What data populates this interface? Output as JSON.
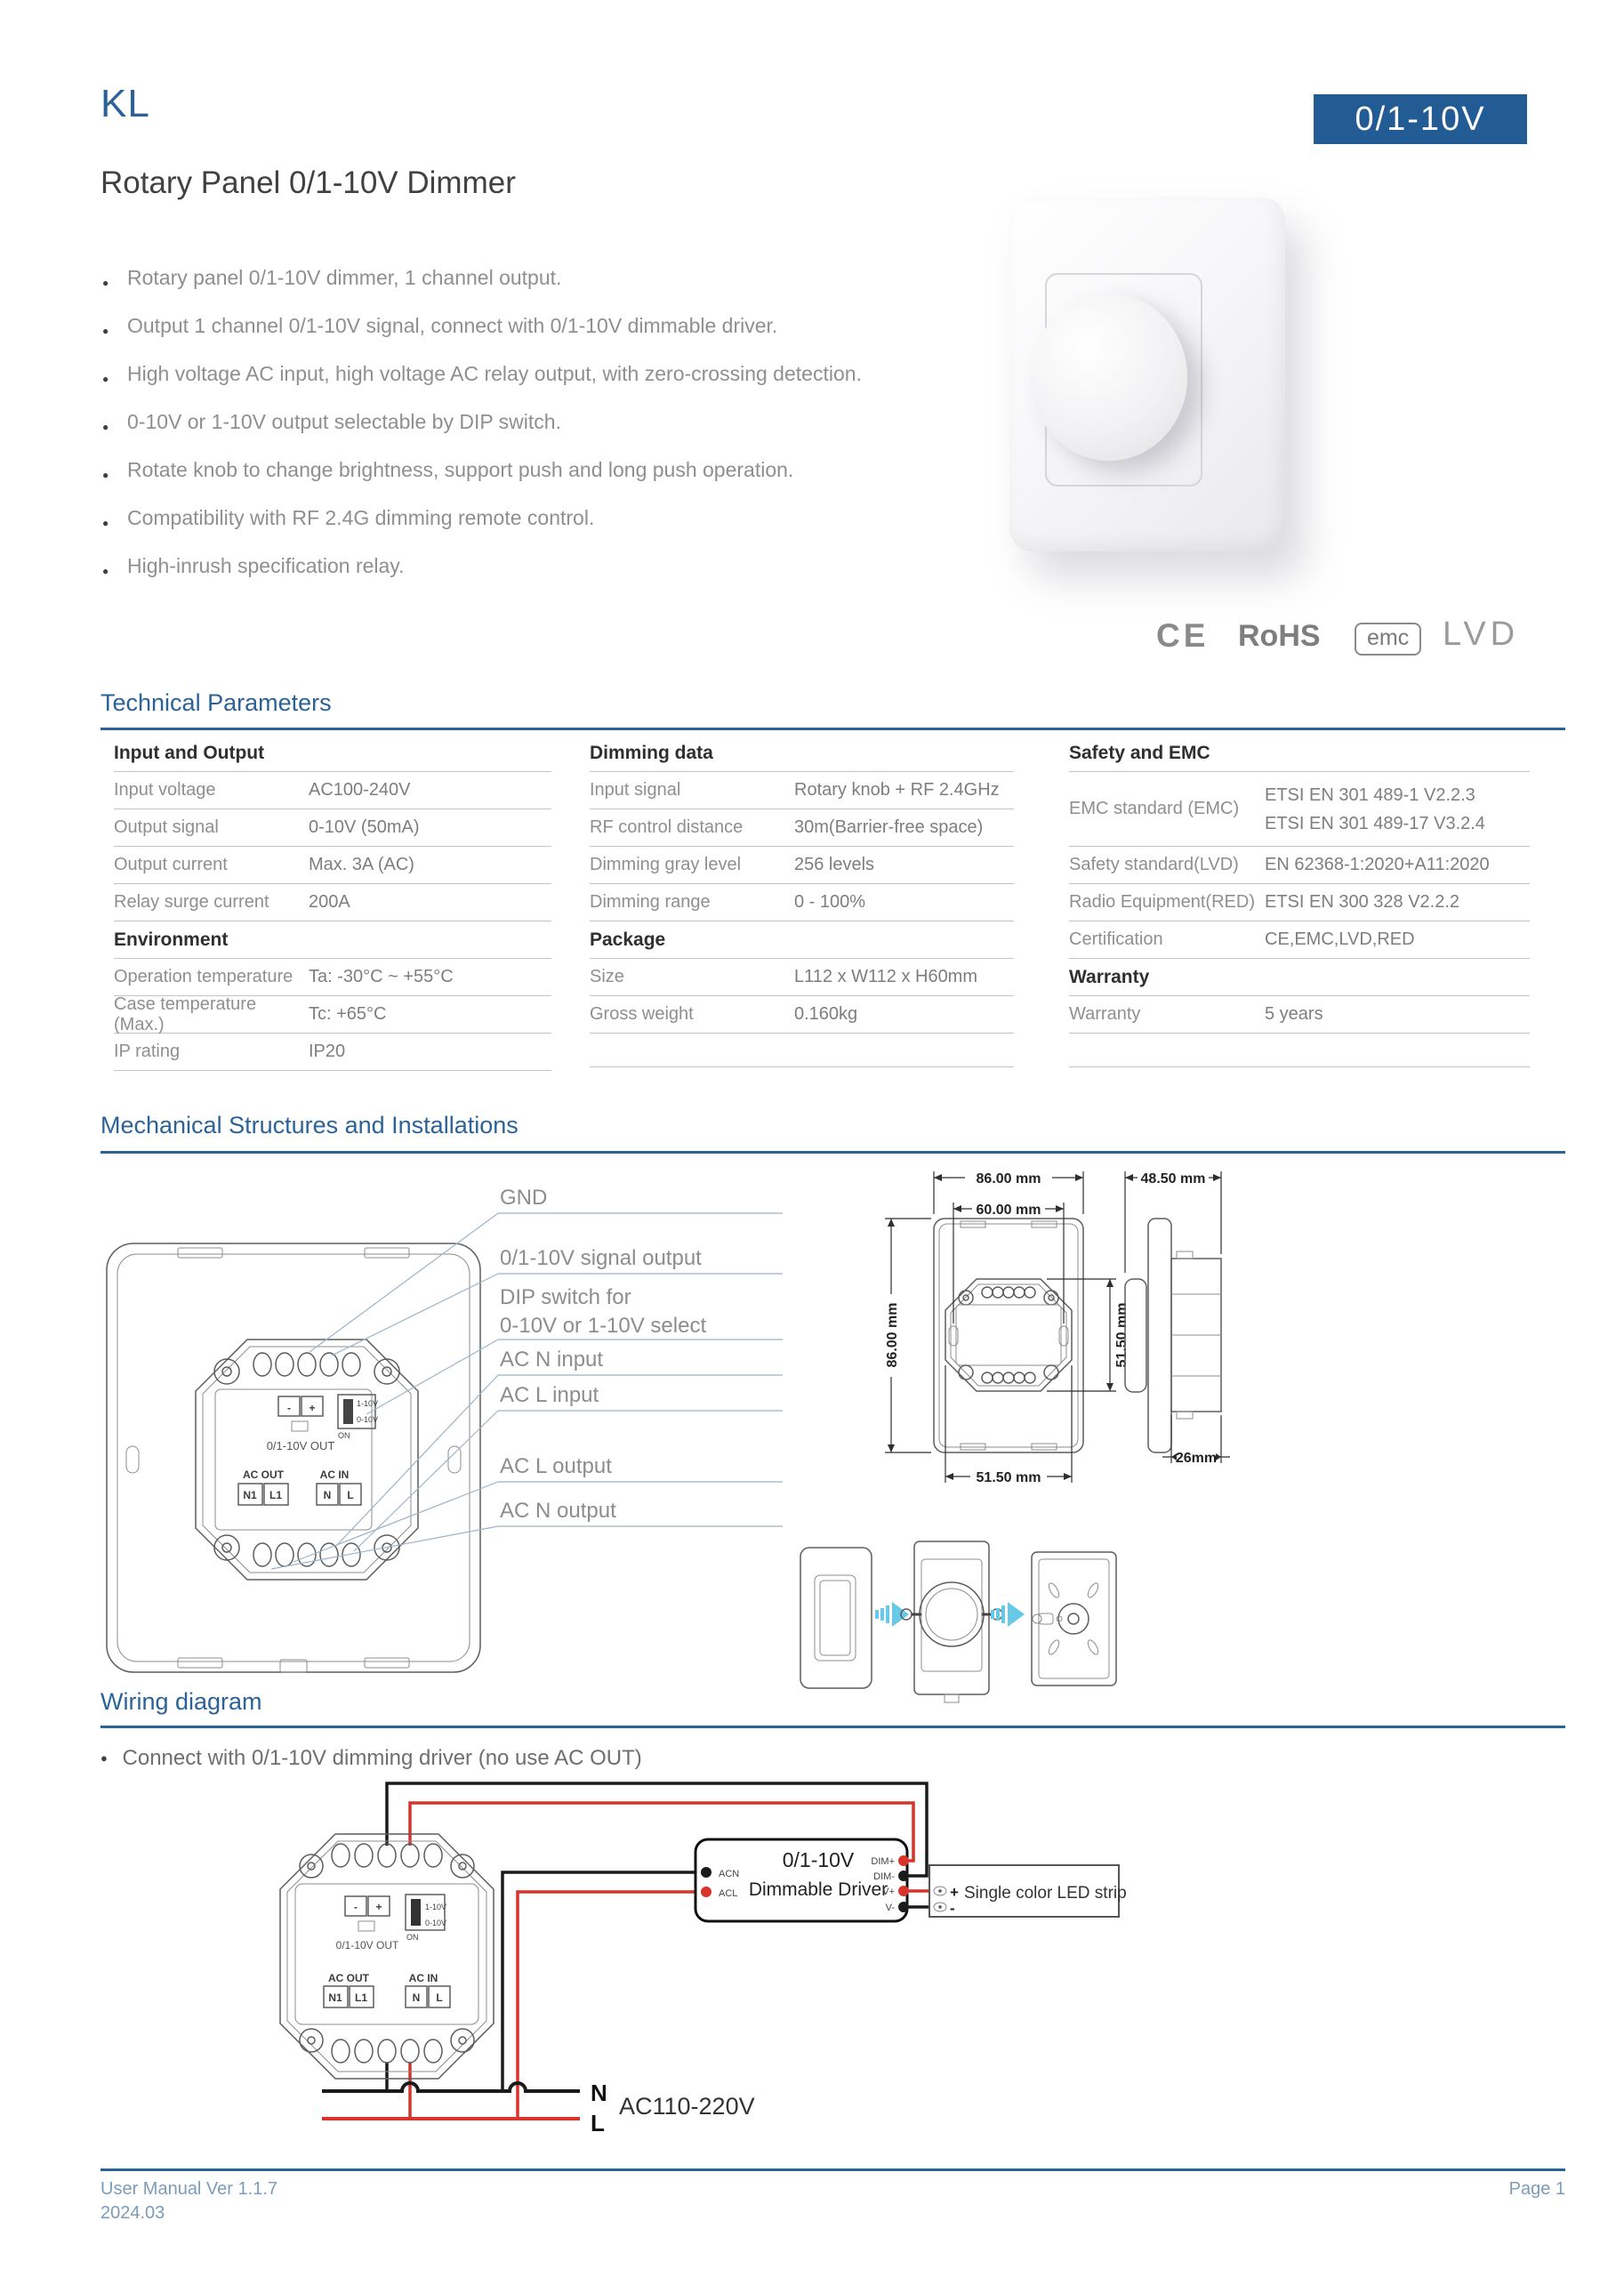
{
  "colors": {
    "accent_blue": "#2b6398",
    "badge_bg": "#235c95",
    "wire_red": "#d8342c",
    "wire_black": "#1b1b1b",
    "arrow_cyan": "#66c9e8"
  },
  "header": {
    "product_code": "KL",
    "title": "Rotary Panel 0/1-10V Dimmer",
    "badge": "0/1-10V"
  },
  "features": [
    "Rotary panel 0/1-10V dimmer, 1 channel output.",
    "Output 1 channel 0/1-10V signal, connect with 0/1-10V dimmable driver.",
    "High voltage AC input, high voltage AC relay output, with zero-crossing detection.",
    "0-10V or 1-10V output selectable by DIP switch.",
    "Rotate knob to change brightness, support push and long push operation.",
    "Compatibility with RF 2.4G dimming remote control.",
    "High-inrush specification relay."
  ],
  "certs": {
    "ce": "CE",
    "rohs": "RoHS",
    "emc": "emc",
    "lvd": "LVD"
  },
  "sections": {
    "technical": "Technical Parameters",
    "mechanical": "Mechanical Structures and Installations",
    "wiring": "Wiring diagram",
    "wiring_note": "Connect with 0/1-10V dimming driver (no use AC OUT)"
  },
  "table": {
    "columns": [
      {
        "groups": [
          {
            "header": "Input and Output",
            "rows": [
              {
                "label": "Input voltage",
                "value": "AC100-240V"
              },
              {
                "label": "Output signal",
                "value": "0-10V (50mA)"
              },
              {
                "label": "Output current",
                "value": "Max. 3A (AC)"
              },
              {
                "label": "Relay surge current",
                "value": "200A"
              }
            ]
          },
          {
            "header": "Environment",
            "rows": [
              {
                "label": "Operation temperature",
                "value": "Ta: -30°C ~ +55°C"
              },
              {
                "label": "Case temperature (Max.)",
                "value": "Tc: +65°C"
              },
              {
                "label": "IP rating",
                "value": "IP20"
              }
            ]
          }
        ]
      },
      {
        "groups": [
          {
            "header": "Dimming data",
            "rows": [
              {
                "label": "Input signal",
                "value": "Rotary knob + RF 2.4GHz"
              },
              {
                "label": "RF control distance",
                "value": "30m(Barrier-free space)"
              },
              {
                "label": "Dimming gray level",
                "value": "256 levels"
              },
              {
                "label": "Dimming range",
                "value": "0 - 100%"
              }
            ]
          },
          {
            "header": "Package",
            "rows": [
              {
                "label": "Size",
                "value": "L112 x W112 x H60mm"
              },
              {
                "label": "Gross weight",
                "value": "0.160kg"
              }
            ]
          }
        ]
      },
      {
        "groups": [
          {
            "header": "Safety and EMC",
            "rows": [
              {
                "label": "EMC standard (EMC)",
                "values": [
                  "ETSI EN 301 489-1 V2.2.3",
                  "ETSI EN 301 489-17 V3.2.4"
                ]
              },
              {
                "label": "Safety standard(LVD)",
                "value": "EN 62368-1:2020+A11:2020"
              },
              {
                "label": "Radio Equipment(RED)",
                "value": "ETSI EN 300 328 V2.2.2"
              },
              {
                "label": "Certification",
                "value": "CE,EMC,LVD,RED"
              }
            ]
          },
          {
            "header": "Warranty",
            "rows": [
              {
                "label": "Warranty",
                "value": "5 years"
              }
            ]
          }
        ]
      }
    ]
  },
  "callouts": {
    "gnd": "GND",
    "signal": "0/1-10V signal output",
    "dip1": "DIP switch for",
    "dip2": "0-10V or 1-10V select",
    "acn_in": "AC N input",
    "acl_in": "AC L input",
    "acl_out": "AC L output",
    "acn_out": "AC N output"
  },
  "module": {
    "minus": "-",
    "plus": "+",
    "out_label": "0/1-10V OUT",
    "dip_top": "1-10V",
    "dip_bottom": "0-10V",
    "dip_on": "ON",
    "ac_out": "AC OUT",
    "ac_in": "AC IN",
    "n1": "N1",
    "l1": "L1",
    "n": "N",
    "l": "L"
  },
  "dims": {
    "w86": "86.00 mm",
    "w60": "60.00 mm",
    "h86": "86.00 mm",
    "h515": "51.50 mm",
    "w515": "51.50 mm",
    "d485": "48.50 mm",
    "d26": "26mm"
  },
  "wiring": {
    "driver_title": "0/1-10V",
    "driver_subtitle": "Dimmable Driver",
    "acn": "ACN",
    "acl": "ACL",
    "dim_plus": "DIM+",
    "dim_minus": "DIM-",
    "v_plus": "V+",
    "v_minus": "V-",
    "led_strip": "Single color LED strip",
    "plus": "+",
    "minus": "-",
    "n": "N",
    "l": "L",
    "ac": "AC110-220V"
  },
  "footer": {
    "version": "User Manual Ver 1.1.7",
    "date": "2024.03",
    "page": "Page 1"
  }
}
